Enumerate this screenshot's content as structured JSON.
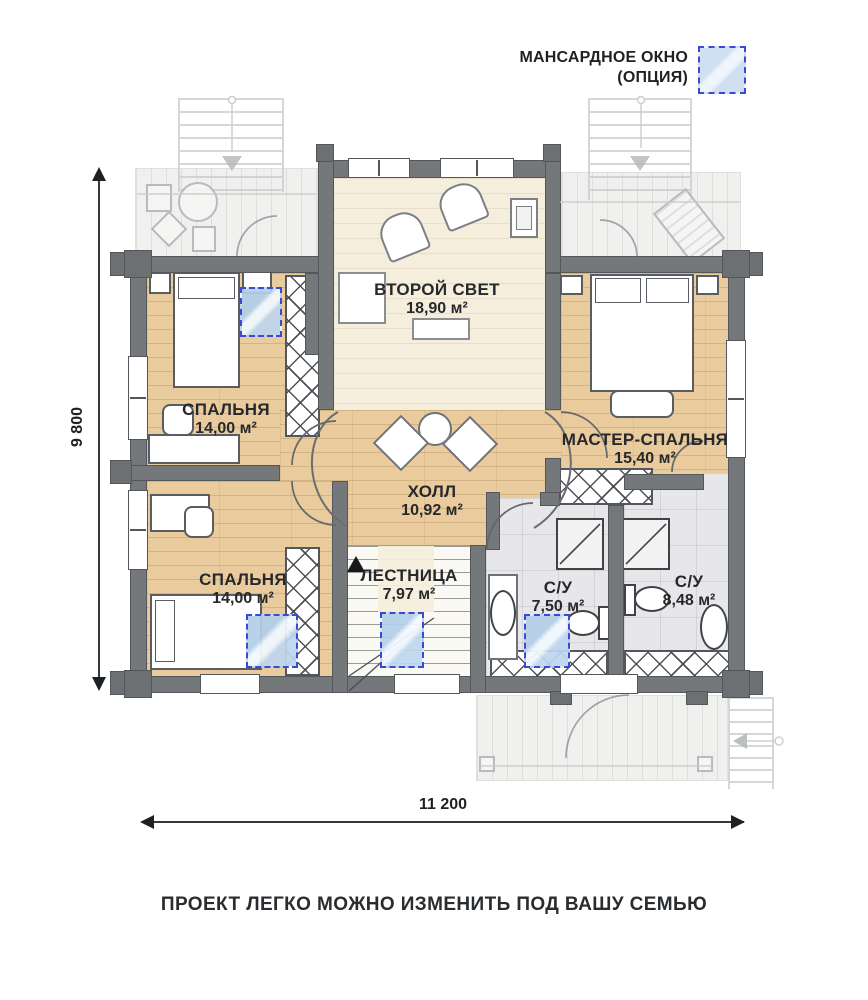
{
  "legend": {
    "line1": "МАНСАРДНОЕ ОКНО",
    "line2": "(ОПЦИЯ)"
  },
  "rooms": [
    {
      "id": "second-light",
      "name": "ВТОРОЙ СВЕТ",
      "area": "18,90 м²"
    },
    {
      "id": "bedroom-top",
      "name": "СПАЛЬНЯ",
      "area": "14,00 м²"
    },
    {
      "id": "master-bedroom",
      "name": "МАСТЕР-СПАЛЬНЯ",
      "area": "15,40 м²"
    },
    {
      "id": "hall",
      "name": "ХОЛЛ",
      "area": "10,92 м²"
    },
    {
      "id": "bedroom-bottom",
      "name": "СПАЛЬНЯ",
      "area": "14,00 м²"
    },
    {
      "id": "staircase",
      "name": "ЛЕСТНИЦА",
      "area": "7,97 м²"
    },
    {
      "id": "bathroom-small",
      "name": "С/У",
      "area": "7,50 м²"
    },
    {
      "id": "bathroom-large",
      "name": "С/У",
      "area": "8,48 м²"
    }
  ],
  "dimensions": {
    "vertical": "9 800",
    "horizontal": "11 200"
  },
  "footer": {
    "slogan": "ПРОЕКТ ЛЕГКО МОЖНО ИЗМЕНИТЬ ПОД ВАШУ СЕМЬЮ"
  },
  "colors": {
    "accent_blue": "#3c49d4",
    "wall_gray": "#6d7073",
    "wood": "#e9cb9d",
    "tile": "#e7e7e9",
    "text": "#26282b"
  }
}
